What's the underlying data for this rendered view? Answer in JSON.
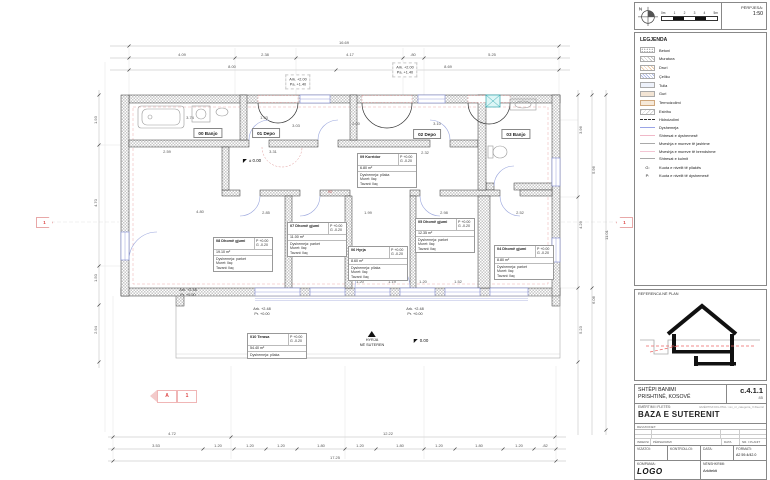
{
  "scale_box": {
    "north_label": "N",
    "ticks": [
      "0m",
      "1",
      "2",
      "3",
      "4",
      "5m"
    ],
    "caption": "PËRPJESA:",
    "value": "1:50"
  },
  "legend": {
    "title": "LEGJENDA",
    "items": [
      {
        "sw": "betoni",
        "label": "Betoni"
      },
      {
        "sw": "muratura",
        "label": "Muratura"
      },
      {
        "sw": "druri",
        "label": "Druri"
      },
      {
        "sw": "celiku",
        "label": "Çeliku"
      },
      {
        "sw": "tulla",
        "label": "Tulla"
      },
      {
        "sw": "guri",
        "label": "Guri"
      },
      {
        "sw": "termo",
        "label": "Termoizolimi"
      },
      {
        "sw": "estrihu",
        "label": "Estrihu"
      },
      {
        "sw": "line-hidro",
        "label": "Hidroizolimi"
      },
      {
        "sw": "line-dysh",
        "label": "Dyshemeja"
      },
      {
        "sw": "line-shtresa",
        "label": "Shtresat e dyshemesë"
      },
      {
        "sw": "line-murj",
        "label": "Mveshja e mureve të jashtme"
      },
      {
        "sw": "line-murb",
        "label": "Mveshja e mureve të brendshme"
      },
      {
        "sw": "line-kulm",
        "label": "Shtresat e kulmit"
      }
    ],
    "notes": [
      {
        "k": "G:",
        "label": "Kuota e nivelit të pllakës"
      },
      {
        "k": "P:",
        "label": "Kuota e nivelit të dyshemesë"
      }
    ]
  },
  "reference": {
    "caption": "REFERENCA NË PLAN"
  },
  "titleblock": {
    "project_name": "SHTËPI BANIMI",
    "project_location": "PRISHTINË, KOSOVË",
    "code": "c.4.1.1",
    "code_sub": "85",
    "sheet_caption": "EMËRTIMI I FLETËS:",
    "digital_caption": "EMËRTIMI DIGJITAL: xxx_nr_categoria_X.fileemri",
    "sheet_title": "BAZA E SUTERENIT",
    "rev_caption": "REVIZIONET:",
    "rev_headers": [
      "INDEKSI",
      "PËRSHKRIMI",
      "DATA",
      "NR. I PLANIT"
    ],
    "drawn_caption": "VIZATOI:",
    "checked_caption": "KONTROLLOI:",
    "date_caption": "DATA:",
    "format_caption": "FORMATI:",
    "format_value": "A2 59.4/42.0",
    "company_caption": "KOMPANIA:",
    "company_value": "LOGO",
    "signature_caption": "NËNSHKRIMI:",
    "signature_value": "Arkitekti"
  },
  "plan": {
    "room_labels": [
      {
        "t": "00 Banjo",
        "x": 208,
        "y": 133
      },
      {
        "t": "01 Depo",
        "x": 266,
        "y": 133
      },
      {
        "t": "02 Depo",
        "x": 427,
        "y": 134
      },
      {
        "t": "03 Banjo",
        "x": 516,
        "y": 134
      }
    ],
    "room_boxes": [
      {
        "title": "09 Korridor",
        "p": "P +0.00",
        "g": "G -0.20",
        "area": "6.80 m²",
        "layers": [
          "Dyshemeja: pllaka",
          "Muret: llaç",
          "Tavani: llaç"
        ],
        "x": 357,
        "y": 153
      },
      {
        "title": "08 Dhomë gjumi",
        "p": "P +0.00",
        "g": "G -0.20",
        "area": "19.10 m²",
        "layers": [
          "Dyshemeja: parket",
          "Muret: llaç",
          "Tavani: llaç"
        ],
        "x": 213,
        "y": 237
      },
      {
        "title": "07 Dhomë gjumi",
        "p": "P +0.00",
        "g": "G -0.20",
        "area": "11.00 m²",
        "layers": [
          "Dyshemeja: parket",
          "Muret: llaç",
          "Tavani: llaç"
        ],
        "x": 287,
        "y": 222
      },
      {
        "title": "06 Hyrja",
        "p": "P +0.00",
        "g": "G -0.20",
        "area": "8.60 m²",
        "layers": [
          "Dyshemeja: pllaka",
          "Muret: llaç",
          "Tavani: llaç"
        ],
        "x": 348,
        "y": 246
      },
      {
        "title": "05 Dhomë gjumi",
        "p": "P +0.00",
        "g": "G -0.20",
        "area": "12.35 m²",
        "layers": [
          "Dyshemeja: parket",
          "Muret: llaç",
          "Tavani: llaç"
        ],
        "x": 415,
        "y": 218
      },
      {
        "title": "04 Dhomë gjumi",
        "p": "P +0.00",
        "g": "G -0.20",
        "area": "8.80 m²",
        "layers": [
          "Dyshemeja: parket",
          "Muret: llaç",
          "Tavani: llaç"
        ],
        "x": 494,
        "y": 245
      },
      {
        "title": "010 Terasa",
        "p": "P +0.00",
        "g": "G -0.20",
        "area": "54.40 m²",
        "layers": [
          "Dyshemeja: pllaka"
        ],
        "x": 247,
        "y": 333
      }
    ],
    "dims": [
      {
        "t": "16.69",
        "x": 344,
        "y": 43
      },
      {
        "t": "4.09",
        "x": 182,
        "y": 55
      },
      {
        "t": "2.38",
        "x": 265,
        "y": 55
      },
      {
        "t": "4.17",
        "x": 350,
        "y": 55
      },
      {
        "t": ".80",
        "x": 413,
        "y": 55
      },
      {
        "t": "5.25",
        "x": 492,
        "y": 55
      },
      {
        "t": "8.00",
        "x": 232,
        "y": 67
      },
      {
        "t": "8.69",
        "x": 448,
        "y": 67
      },
      {
        "t": "4.72",
        "x": 172,
        "y": 434
      },
      {
        "t": "12.22",
        "x": 388,
        "y": 434
      },
      {
        "t": "3.53",
        "x": 156,
        "y": 446
      },
      {
        "t": "1.20",
        "x": 218,
        "y": 446
      },
      {
        "t": "1.20",
        "x": 250,
        "y": 446
      },
      {
        "t": "1.20",
        "x": 281,
        "y": 446
      },
      {
        "t": "1.80",
        "x": 321,
        "y": 446
      },
      {
        "t": "1.20",
        "x": 360,
        "y": 446
      },
      {
        "t": "1.80",
        "x": 400,
        "y": 446
      },
      {
        "t": "1.20",
        "x": 439,
        "y": 446
      },
      {
        "t": "1.80",
        "x": 479,
        "y": 446
      },
      {
        "t": "1.20",
        "x": 519,
        "y": 446
      },
      {
        "t": ".82",
        "x": 545,
        "y": 446
      },
      {
        "t": "17.25",
        "x": 335,
        "y": 458
      },
      {
        "t": "1.93",
        "x": 96,
        "y": 120,
        "r": 1
      },
      {
        "t": "4.70",
        "x": 96,
        "y": 203,
        "r": 1
      },
      {
        "t": "1.50",
        "x": 96,
        "y": 278,
        "r": 1
      },
      {
        "t": "2.94",
        "x": 96,
        "y": 330,
        "r": 1
      },
      {
        "t": "3.96",
        "x": 581,
        "y": 130,
        "r": 1
      },
      {
        "t": "4.29",
        "x": 581,
        "y": 225,
        "r": 1
      },
      {
        "t": "5.23",
        "x": 581,
        "y": 330,
        "r": 1
      },
      {
        "t": "5.96",
        "x": 594,
        "y": 170,
        "r": 1
      },
      {
        "t": "6.06",
        "x": 594,
        "y": 300,
        "r": 1
      },
      {
        "t": "11.01",
        "x": 607,
        "y": 235,
        "r": 1
      },
      {
        "t": "3.74",
        "x": 190,
        "y": 118
      },
      {
        "t": "1.93",
        "x": 264,
        "y": 118
      },
      {
        "t": "3.03",
        "x": 296,
        "y": 126
      },
      {
        "t": "2.00",
        "x": 356,
        "y": 124
      },
      {
        "t": "3.10",
        "x": 437,
        "y": 124
      },
      {
        "t": "2.32",
        "x": 425,
        "y": 153
      },
      {
        "t": "2.59",
        "x": 167,
        "y": 152
      },
      {
        "t": "3.31",
        "x": 273,
        "y": 152
      },
      {
        "t": "4.80",
        "x": 200,
        "y": 212
      },
      {
        "t": "2.85",
        "x": 266,
        "y": 213
      },
      {
        "t": "1.99",
        "x": 368,
        "y": 213
      },
      {
        "t": "2.98",
        "x": 444,
        "y": 213
      },
      {
        "t": "2.52",
        "x": 520,
        "y": 213
      },
      {
        "t": "4.31",
        "x": 338,
        "y": 243,
        "r": 1
      },
      {
        "t": "1.20",
        "x": 360,
        "y": 282
      },
      {
        "t": "1.19",
        "x": 392,
        "y": 282
      },
      {
        "t": "1.20",
        "x": 423,
        "y": 282
      },
      {
        "t": "1.52",
        "x": 458,
        "y": 282
      },
      {
        "t": "80",
        "x": 257,
        "y": 136,
        "c": 1
      },
      {
        "t": "90",
        "x": 330,
        "y": 192,
        "c": 1
      }
    ],
    "levels": [
      {
        "kind": "pm",
        "t": "± 0.00",
        "x": 252,
        "y": 161
      },
      {
        "kind": "pm",
        "t": "0.00",
        "x": 421,
        "y": 341
      },
      {
        "kind": "pair",
        "a": "Ark. +2.48",
        "b": "Pr. +0.00",
        "x": 188,
        "y": 293
      },
      {
        "kind": "pair",
        "a": "Ark. +2.48",
        "b": "Pr. +0.00",
        "x": 262,
        "y": 312
      },
      {
        "kind": "pair",
        "a": "Ark. +2.48",
        "b": "Pr. +0.00",
        "x": 415,
        "y": 312
      },
      {
        "kind": "pairbox",
        "a": "Ark. +2.00",
        "b": "Pa. +1.40",
        "x": 298,
        "y": 82
      },
      {
        "kind": "pairbox",
        "a": "Ark. +2.00",
        "b": "Pa. +1.40",
        "x": 405,
        "y": 70
      }
    ],
    "entry": {
      "line1": "HYRJA",
      "line2": "NË SUTEREN",
      "x": 372,
      "y": 331
    },
    "markers": {
      "section_letter": "A",
      "section_number": "1",
      "axis_left": "1",
      "axis_right": "1"
    }
  }
}
